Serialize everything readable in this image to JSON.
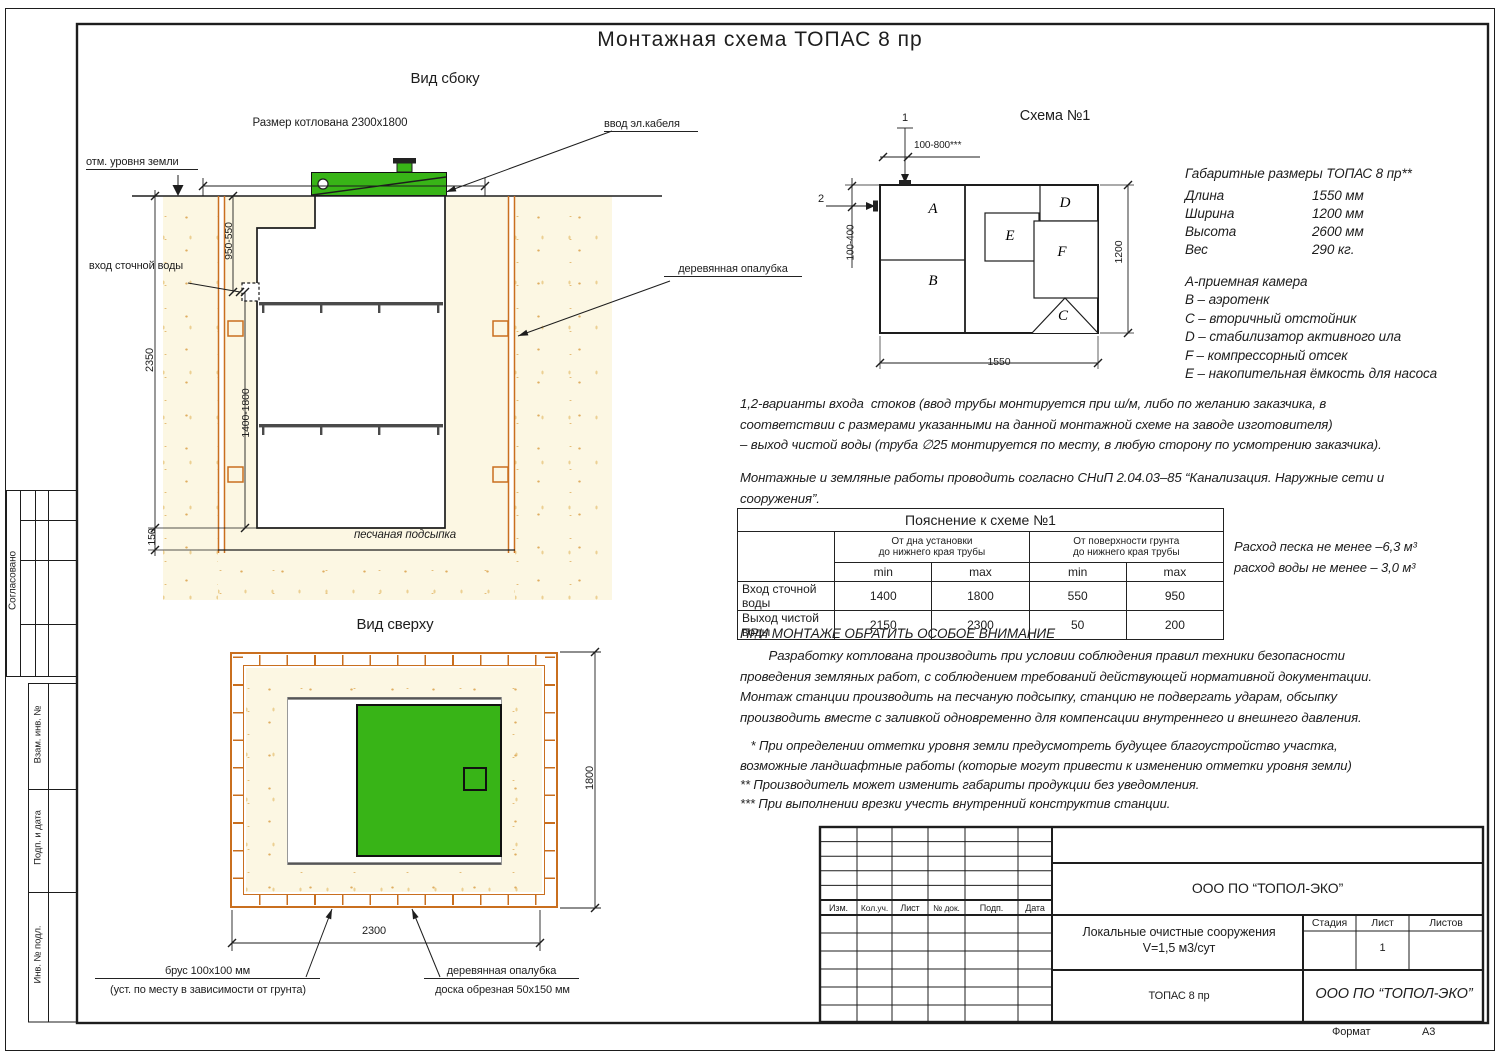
{
  "page": {
    "title": "Монтажная схема ТОПАС 8 пр",
    "format_label": "Формат",
    "format_value": "А3"
  },
  "strip": {
    "agreed": "Согласовано",
    "vzam": "Взам. инв. №",
    "podp": "Подп. и дата",
    "inv": "Инв. № подл."
  },
  "side": {
    "title": "Вид сбоку",
    "pit_dim": "Размер котлована 2300x1800",
    "ground_label": "отм. уровня земли",
    "cable_label": "ввод эл.кабеля",
    "inlet_label": "вход сточной воды",
    "formwork_label": "деревянная опалубка",
    "sand_label": "песчаная подсыпка",
    "d2350": "2350",
    "d950": "950-550",
    "d1400": "1400-1800",
    "d150": "150"
  },
  "top": {
    "title": "Вид сверху",
    "d2300": "2300",
    "d1800": "1800",
    "beam": "брус 100x100 мм",
    "beam_note": "(уст. по месту в зависимости от грунта)",
    "formwork": "деревянная опалубка",
    "board": "доска обрезная 50x150 мм"
  },
  "schema": {
    "title": "Схема №1",
    "a": "A",
    "b": "B",
    "c": "C",
    "d": "D",
    "e": "E",
    "f": "F",
    "m1": "1",
    "m2": "2",
    "d_top": "100-800***",
    "d_left": "100-400",
    "d_w": "1550",
    "d_h": "1200"
  },
  "specs": {
    "heading": "Габаритные размеры ТОПАС 8 пр**",
    "rows": [
      {
        "label": "Длина",
        "value": "1550 мм"
      },
      {
        "label": "Ширина",
        "value": "1200 мм"
      },
      {
        "label": "Высота",
        "value": "2600 мм"
      },
      {
        "label": "Вес",
        "value": "290 кг."
      }
    ],
    "legend": [
      "А-приемная  камера",
      "В – аэротенк",
      "С – вторичный отстойник",
      "D – стабилизатор активного  ила",
      "F  – компрессорный отсек",
      "Е – накопительная ёмкость для насоса"
    ]
  },
  "notes": {
    "variants": "1,2-варианты входа  стоков (ввод трубы монтируется при ш/м, либо по желанию заказчика, в\nсоответствии с размерами указанными на данной монтажной схеме на заводе изготовителя)\n– выход чистой воды (труба ∅25 монтируется по месту, в любую сторону по усмотрению заказчика).",
    "snip": "Монтажные и земляные работы проводить согласно СНиП 2.04.03–85 “Канализация. Наружные сети и\nсооружения”.",
    "sand": "Расход песка не менее –6,3 м³",
    "water": "расход воды не менее – 3,0 м³",
    "attention_title": "ПРИ МОНТАЖЕ ОБРАТИТЬ ОСОБОЕ ВНИМАНИЕ",
    "attention_body": "        Разработку котлована производить при условии соблюдения правил техники безопасности\nпроведения земляных работ, с соблюдением требований действующей нормативной документации.\nМонтаж станции производить на песчаную подсыпку, станцию не подвергать ударам, обсыпку\nпроизводить вместе с заливкой одновременно для компенсации внутреннего и внешнего давления.",
    "fn1": "   * При определении отметки уровня земли предусмотреть будущее благоустройство участка,\nвозможные ландшафтные работы (которые могут привести к изменению отметки уровня земли)",
    "fn2": "** Производитель может изменить габариты продукции без уведомления.",
    "fn3": "*** При выполнении врезки учесть внутренний конструктив станции."
  },
  "xtable": {
    "title": "Пояснение к схеме №1",
    "group1": "От дна установки\nдо нижнего края трубы",
    "group2": "От поверхности грунта\nдо нижнего края трубы",
    "min1": "min",
    "max1": "max",
    "min2": "min",
    "max2": "max",
    "rows": [
      {
        "label": "Вход сточной воды",
        "c1": "1400",
        "c2": "1800",
        "c3": "550",
        "c4": "950"
      },
      {
        "label": "Выход чистой воды",
        "c1": "2150",
        "c2": "2300",
        "c3": "50",
        "c4": "200"
      }
    ]
  },
  "stamp": {
    "rev": [
      "Изм.",
      "Кол.уч.",
      "Лист",
      "№ док.",
      "Подп.",
      "Дата"
    ],
    "company": "ООО ПО “ТОПОЛ-ЭКО”",
    "object1": "Локальные очистные сооружения",
    "object2": "V=1,5 м3/сут",
    "stage": "Стадия",
    "sheet_label": "Лист",
    "sheets_label": "Листов",
    "sheet_no": "1",
    "product": "ТОПАС 8 пр",
    "company2": "ООО ПО “ТОПОЛ-ЭКО”"
  }
}
